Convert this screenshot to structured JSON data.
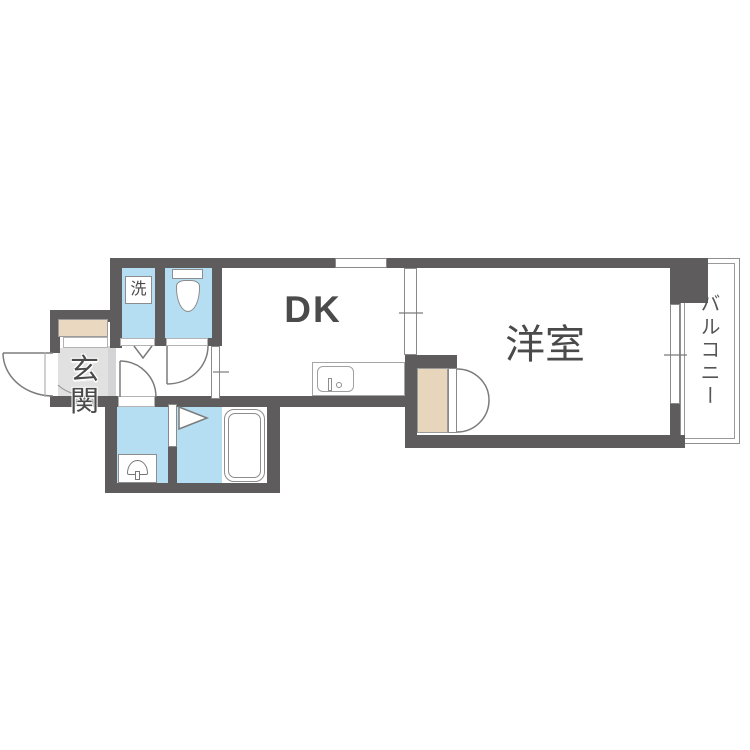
{
  "floor_plan": {
    "rooms": {
      "dk": "DK",
      "western_room": "洋室",
      "entrance": "玄関",
      "balcony": "バルコニー",
      "laundry_box": "洗"
    },
    "fixtures": [
      "toilet",
      "washing-machine-space",
      "kitchen-sink",
      "bathtub",
      "wash-basin",
      "closet",
      "shoe-cabinet"
    ],
    "colors": {
      "wall": "#5e5c5c",
      "wet_area_floor": "#b5def2",
      "closet_fill": "#e7d5bc",
      "entrance_floor": "#e1e1e2",
      "outline": "#8a8a8a",
      "label_text": "#4a4a4a",
      "background": "#ffffff"
    }
  }
}
